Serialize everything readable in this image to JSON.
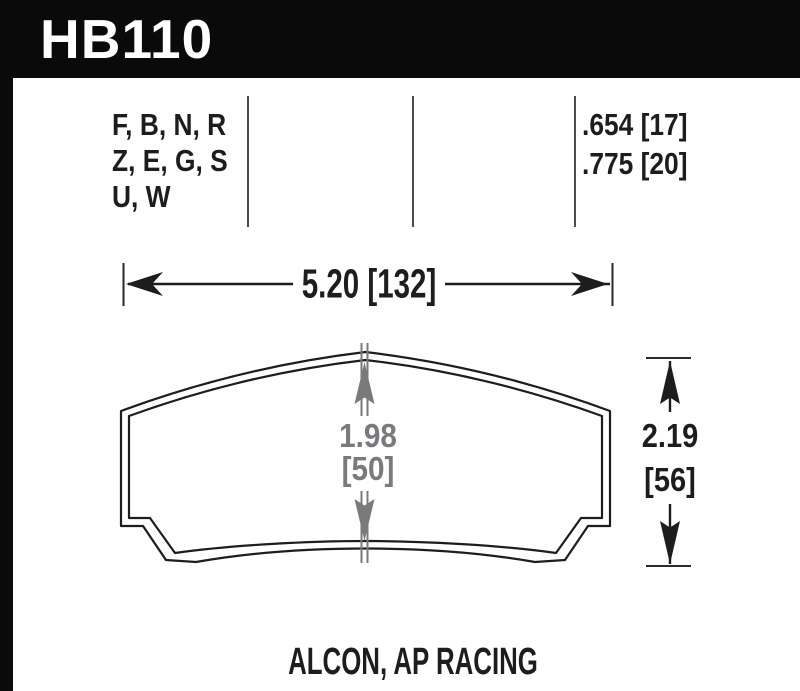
{
  "part": {
    "code": "HB110"
  },
  "compounds": {
    "lines": [
      "F, B, N, R",
      "Z, E, G, S",
      "U, W"
    ]
  },
  "pad_thickness": {
    "lines": [
      ".654 [17]",
      ".775 [20]"
    ]
  },
  "dimensions": {
    "width": "5.20 [132]",
    "inner_height": {
      "value": "1.98",
      "bracket": "[50]"
    },
    "overall_height": {
      "value": "2.19",
      "bracket": "[56]"
    }
  },
  "caliper_label": "ALCON, AP RACING",
  "colors": {
    "banner_bg": "#0a0a0a",
    "banner_text": "#ffffff",
    "line_black": "#1d1d1d",
    "dim_gray": "#7a7a7c",
    "divider_gray": "#4c4c4e",
    "background": "#ffffff"
  }
}
